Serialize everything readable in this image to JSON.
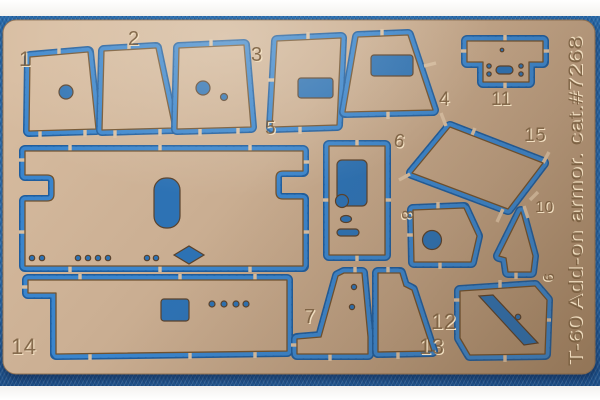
{
  "colors": {
    "fabric_blue": "#2e7abf",
    "moat_blue": "#3a85cd",
    "moat_shadow_blue": "#1f5d9d",
    "brass_light": "#d7bca0",
    "brass_mid": "#c8ac90",
    "brass_dark": "#a78a6b",
    "etch_shadow": "#765a3c",
    "etch_highlight": "#f3e2c4",
    "photo_margin_white": "#fbfbfa"
  },
  "fret": {
    "side_text": "T-60 Add-on armor. cat.#7268",
    "part_labels": [
      {
        "text": "1",
        "x": 19,
        "y": 66,
        "size": 21,
        "rot": 0
      },
      {
        "text": "2",
        "x": 128,
        "y": 45,
        "size": 20,
        "rot": 0
      },
      {
        "text": "3",
        "x": 251,
        "y": 61,
        "size": 20,
        "rot": 0
      },
      {
        "text": "4",
        "x": 439,
        "y": 105,
        "size": 19,
        "rot": 0
      },
      {
        "text": "5",
        "x": 265,
        "y": 134,
        "size": 19,
        "rot": 0
      },
      {
        "text": "6",
        "x": 393,
        "y": 146,
        "size": 19,
        "rot": 10
      },
      {
        "text": "7",
        "x": 304,
        "y": 323,
        "size": 20,
        "rot": 0
      },
      {
        "text": "8",
        "x": 402,
        "y": 210,
        "size": 17,
        "rot": 90
      },
      {
        "text": "9",
        "x": 544,
        "y": 273,
        "size": 15,
        "rot": 90
      },
      {
        "text": "10",
        "x": 535,
        "y": 212,
        "size": 16,
        "rot": 0
      },
      {
        "text": "11",
        "x": 491,
        "y": 105,
        "size": 19,
        "rot": 0
      },
      {
        "text": "12",
        "x": 431,
        "y": 329,
        "size": 22,
        "rot": 0
      },
      {
        "text": "13",
        "x": 419,
        "y": 354,
        "size": 22,
        "rot": 0
      },
      {
        "text": "14",
        "x": 11,
        "y": 354,
        "size": 22,
        "rot": 0
      },
      {
        "text": "15",
        "x": 524,
        "y": 141,
        "size": 19,
        "rot": 0
      }
    ],
    "parts": [
      {
        "name": "part-5",
        "d": "M25,151 L303,151 L303,171 L283,171 Q276,171 276,178 L276,192 Q276,199 283,199 L303,199 L303,266 L25,266 L25,201 L47,201 Q54,201 54,194 L54,182 Q54,175 47,175 L25,175 Z",
        "holes": [
          {
            "t": "r",
            "x": 154,
            "y": 178,
            "w": 26,
            "h": 50,
            "rx": 12
          },
          {
            "t": "p",
            "d": "M174,255 L189,246 L204,255 L189,264 Z"
          },
          {
            "t": "c",
            "x": 32,
            "y": 258,
            "r": 2.7
          },
          {
            "t": "c",
            "x": 42,
            "y": 258,
            "r": 2.7
          },
          {
            "t": "c",
            "x": 78,
            "y": 258,
            "r": 2.7
          },
          {
            "t": "c",
            "x": 88,
            "y": 258,
            "r": 2.7
          },
          {
            "t": "c",
            "x": 98,
            "y": 258,
            "r": 2.7
          },
          {
            "t": "c",
            "x": 108,
            "y": 258,
            "r": 2.7
          },
          {
            "t": "c",
            "x": 147,
            "y": 258,
            "r": 2.7
          },
          {
            "t": "c",
            "x": 156,
            "y": 258,
            "r": 2.7
          }
        ],
        "tabs": [
          [
            70,
            145,
            70,
            157
          ],
          [
            160,
            145,
            160,
            157
          ],
          [
            250,
            145,
            250,
            157
          ],
          [
            70,
            260,
            70,
            272
          ],
          [
            160,
            260,
            160,
            272
          ],
          [
            250,
            260,
            250,
            272
          ],
          [
            19,
            160,
            31,
            160
          ],
          [
            19,
            232,
            31,
            232
          ],
          [
            297,
            162,
            309,
            162
          ],
          [
            297,
            232,
            309,
            232
          ]
        ]
      },
      {
        "name": "part-14",
        "d": "M28,280 L287,280 L287,351 L56,354 L56,293 L28,293 Z",
        "holes": [
          {
            "t": "r",
            "x": 161,
            "y": 299,
            "w": 28,
            "h": 22,
            "rx": 3
          },
          {
            "t": "c",
            "x": 212,
            "y": 304,
            "r": 3
          },
          {
            "t": "c",
            "x": 224,
            "y": 304,
            "r": 3
          },
          {
            "t": "c",
            "x": 236,
            "y": 304,
            "r": 3
          },
          {
            "t": "c",
            "x": 246,
            "y": 304,
            "r": 3
          }
        ],
        "tabs": [
          [
            80,
            274,
            80,
            286
          ],
          [
            180,
            274,
            180,
            286
          ],
          [
            255,
            274,
            255,
            286
          ],
          [
            90,
            347,
            90,
            360
          ],
          [
            190,
            346,
            190,
            359
          ],
          [
            255,
            345,
            255,
            358
          ],
          [
            22,
            287,
            34,
            287
          ]
        ]
      },
      {
        "name": "part-1",
        "d": "M30,57 L88,52 L96,129 L29,131 Z",
        "holes": [
          {
            "t": "c",
            "x": 66,
            "y": 92,
            "r": 7
          }
        ],
        "tabs": [
          [
            59,
            46,
            59,
            60
          ],
          [
            40,
            124,
            40,
            139
          ],
          [
            85,
            122,
            85,
            137
          ]
        ]
      },
      {
        "name": "part-2",
        "d": "M104,51 L156,48 L173,128 L102,130 Z",
        "holes": [],
        "tabs": [
          [
            129,
            42,
            129,
            56
          ],
          [
            115,
            123,
            115,
            138
          ],
          [
            160,
            121,
            160,
            136
          ]
        ]
      },
      {
        "name": "part-3",
        "d": "M179,48 L244,45 L251,127 L177,129 Z",
        "holes": [
          {
            "t": "c",
            "x": 203,
            "y": 88,
            "r": 7
          },
          {
            "t": "c",
            "x": 224,
            "y": 97,
            "r": 3.5
          }
        ],
        "tabs": [
          [
            211,
            39,
            211,
            53
          ],
          [
            200,
            121,
            200,
            136
          ],
          [
            238,
            119,
            238,
            134
          ]
        ]
      },
      {
        "name": "part-3a",
        "d": "M277,41 L341,38 L337,125 L272,127 Z",
        "holes": [
          {
            "t": "r",
            "x": 298,
            "y": 78,
            "w": 35,
            "h": 20,
            "rx": 3
          }
        ],
        "tabs": [
          [
            308,
            32,
            308,
            46
          ],
          [
            300,
            119,
            300,
            134
          ],
          [
            268,
            80,
            280,
            80
          ]
        ]
      },
      {
        "name": "part-4",
        "d": "M358,37 L408,35 L433,110 L345,112 Z",
        "holes": [
          {
            "t": "r",
            "x": 371,
            "y": 55,
            "w": 42,
            "h": 21,
            "rx": 3
          }
        ],
        "tabs": [
          [
            382,
            29,
            382,
            43
          ],
          [
            388,
            104,
            388,
            119
          ],
          [
            424,
            66,
            436,
            63
          ]
        ]
      },
      {
        "name": "part-11",
        "d": "M467,41 L543,41 L543,62 L529,62 L529,82 L483,82 L483,62 L467,62 Z",
        "holes": [
          {
            "t": "c",
            "x": 502,
            "y": 50,
            "r": 1.8
          },
          {
            "t": "c",
            "x": 489,
            "y": 66,
            "r": 2.2
          },
          {
            "t": "c",
            "x": 489,
            "y": 74,
            "r": 2.2
          },
          {
            "t": "c",
            "x": 521,
            "y": 66,
            "r": 2.2
          },
          {
            "t": "c",
            "x": 521,
            "y": 74,
            "r": 2.2
          },
          {
            "t": "r",
            "x": 496,
            "y": 66,
            "w": 17,
            "h": 8,
            "rx": 4
          }
        ],
        "tabs": [
          [
            505,
            35,
            505,
            47
          ],
          [
            461,
            51,
            473,
            51
          ],
          [
            537,
            51,
            549,
            51
          ],
          [
            505,
            76,
            505,
            88
          ]
        ]
      },
      {
        "name": "part-15",
        "d": "M450,127 L543,163 L508,209 L412,173 Z",
        "holes": [],
        "tabs": [
          [
            441,
            113,
            446,
            126
          ],
          [
            549,
            152,
            543,
            163
          ],
          [
            497,
            222,
            503,
            209
          ],
          [
            399,
            180,
            410,
            174
          ],
          [
            475,
            128,
            470,
            140
          ],
          [
            530,
            200,
            538,
            192
          ]
        ]
      },
      {
        "name": "part-6",
        "d": "M329,146 L385,146 L385,255 L329,255 Z",
        "holes": [
          {
            "t": "r",
            "x": 337,
            "y": 160,
            "w": 30,
            "h": 46,
            "rx": 5
          },
          {
            "t": "c",
            "x": 342,
            "y": 201,
            "r": 6.5
          },
          {
            "t": "e",
            "x": 346,
            "y": 219,
            "rx": 5.5,
            "ry": 3.5
          },
          {
            "t": "r",
            "x": 337,
            "y": 229,
            "w": 22,
            "h": 7,
            "rx": 3.5
          }
        ],
        "tabs": [
          [
            357,
            140,
            357,
            152
          ],
          [
            357,
            249,
            357,
            261
          ],
          [
            323,
            200,
            335,
            200
          ],
          [
            379,
            200,
            391,
            200
          ]
        ]
      },
      {
        "name": "part-8",
        "d": "M413,210 L464,208 L477,236 L471,262 L414,262 Z",
        "holes": [
          {
            "t": "c",
            "x": 432,
            "y": 240,
            "r": 9.5
          }
        ],
        "tabs": [
          [
            438,
            202,
            438,
            214
          ],
          [
            440,
            256,
            440,
            269
          ],
          [
            407,
            235,
            419,
            235
          ]
        ]
      },
      {
        "name": "part-10",
        "d": "M521,212 L533,256 L531,272 L508,272 L506,258 L499,256 Z",
        "holes": [],
        "tabs": [
          [
            524,
            206,
            528,
            218
          ],
          [
            516,
            266,
            516,
            279
          ]
        ]
      },
      {
        "name": "part-7",
        "d": "M344,273 L362,273 L368,337 L368,354 L297,354 L297,339 L321,337 L338,276 Z",
        "holes": [
          {
            "t": "c",
            "x": 354,
            "y": 287,
            "r": 2.6
          },
          {
            "t": "c",
            "x": 352,
            "y": 307,
            "r": 2.6
          }
        ],
        "tabs": [
          [
            355,
            267,
            355,
            279
          ],
          [
            330,
            348,
            330,
            361
          ],
          [
            291,
            345,
            303,
            345
          ]
        ]
      },
      {
        "name": "part-13",
        "d": "M378,273 L400,273 L404,286 L412,290 L432,351 L378,352 Z",
        "holes": [],
        "tabs": [
          [
            388,
            267,
            388,
            279
          ],
          [
            398,
            346,
            398,
            359
          ]
        ]
      },
      {
        "name": "part-12",
        "d": "M460,291 L535,286 L547,300 L545,354 L470,355 L460,338 Z",
        "holes": [
          {
            "t": "p",
            "d": "M479,296 L493,295 L538,343 L524,345 Z"
          },
          {
            "t": "c",
            "x": 518,
            "y": 317,
            "r": 2.8
          }
        ],
        "tabs": [
          [
            500,
            280,
            500,
            292
          ],
          [
            505,
            349,
            505,
            362
          ],
          [
            454,
            300,
            466,
            300
          ],
          [
            551,
            320,
            539,
            320
          ]
        ]
      }
    ]
  }
}
